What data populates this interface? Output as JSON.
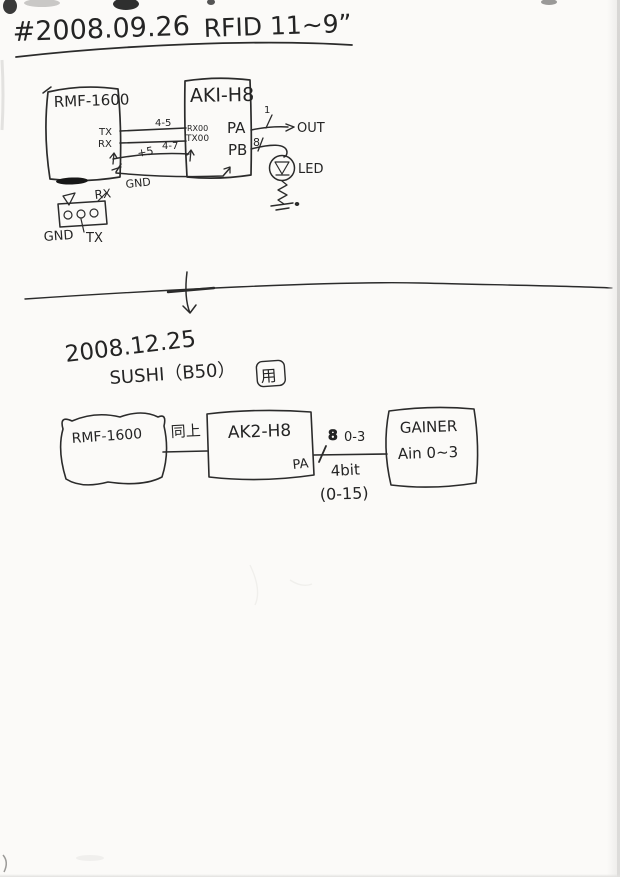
{
  "header": {
    "date": "#2008.09.26",
    "title": "RFID 11~9”"
  },
  "diagram1": {
    "rmf": {
      "label": "RMF-1600",
      "pin_tx": "TX",
      "pin_rx": "RX"
    },
    "aki": {
      "label": "AKI-H8",
      "pin_rx0": "RX00",
      "pin_tx0": "TX00",
      "pin_pa": "PA",
      "pin_pb": "PB"
    },
    "wires": {
      "tx_rx": "4-5",
      "rx_tx": "4-7",
      "vcc": "+5",
      "gnd": "GND"
    },
    "out": {
      "count": "1",
      "label": "OUT"
    },
    "led": {
      "count": "8",
      "label": "LED"
    },
    "connector": {
      "rx": "RX",
      "gnd": "GND",
      "tx": "TX"
    }
  },
  "section2": {
    "date": "2008.12.25",
    "subtitle": "SUSHI（B50）",
    "stamp": "用"
  },
  "diagram2": {
    "rmf": {
      "label": "RMF-1600"
    },
    "link1": "同上",
    "ak2": {
      "label": "AK2-H8",
      "pin_pa": "PA"
    },
    "bus": {
      "mark": "8",
      "range": "0-3",
      "width": "4bit",
      "values": "(0-15)"
    },
    "gainer": {
      "line1": "GAINER",
      "line2": "Ain 0~3"
    }
  }
}
